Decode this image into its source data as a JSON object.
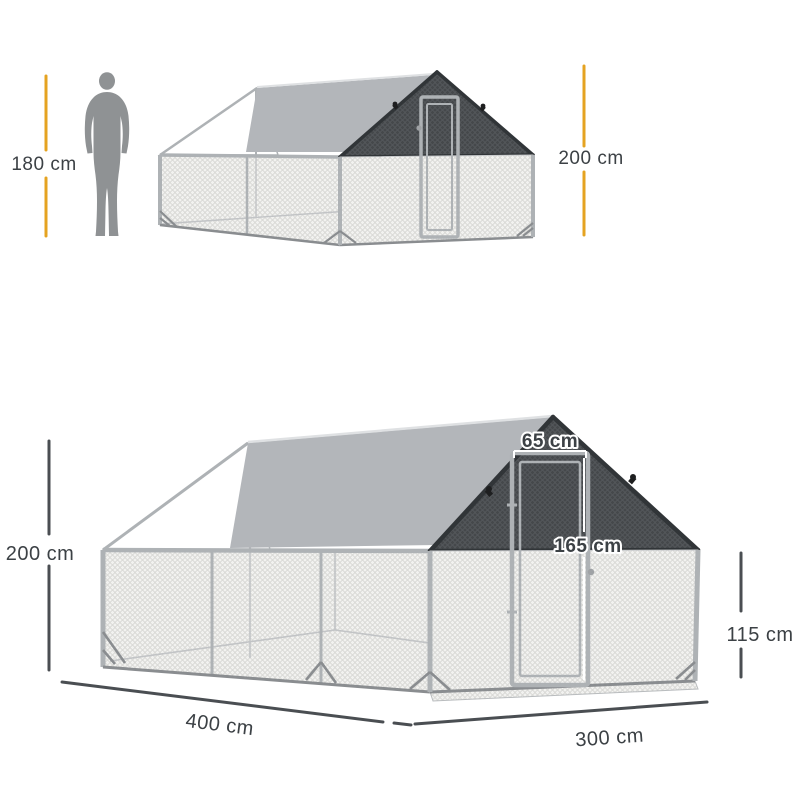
{
  "top_view": {
    "human_height_label": "180 cm",
    "coop_height_label": "200 cm"
  },
  "bottom_view": {
    "height_label": "200 cm",
    "door_width_label": "65 cm",
    "door_height_label": "165 cm",
    "side_wall_height_label": "115 cm",
    "base_depth_label": "400 cm",
    "base_width_label": "300 cm"
  },
  "colors": {
    "accent_yellow": "#E5A321",
    "measure_dark": "#4A4E52",
    "label_text": "#3C4145",
    "silhouette_gray": "#8F9294",
    "tarp_gray": "#B3B6BA",
    "dark_mesh": "#45484B",
    "mesh_light": "#F2F2F0",
    "frame_silver": "#AEB2B5"
  }
}
